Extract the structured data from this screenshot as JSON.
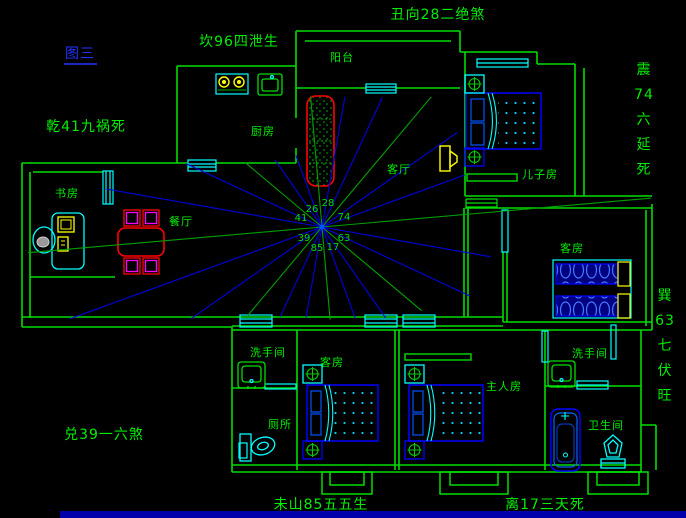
{
  "figure": {
    "label": "图三",
    "color": "#2233ff"
  },
  "annotations": {
    "items": [
      {
        "id": "fig-label",
        "text": "图三",
        "x": 80,
        "y": 58,
        "vertical": false,
        "blue": true,
        "underline": true
      },
      {
        "id": "annot-kan",
        "text": "坎96四泄生",
        "x": 239,
        "y": 46,
        "vertical": false
      },
      {
        "id": "annot-chou",
        "text": "丑向28二绝煞",
        "x": 438,
        "y": 19,
        "vertical": false
      },
      {
        "id": "annot-qian",
        "text": "乾41九祸死",
        "x": 86,
        "y": 131,
        "vertical": false
      },
      {
        "id": "annot-zhen",
        "text": "震74六延死",
        "x": 644,
        "y": 74,
        "vertical": true,
        "lh": 25
      },
      {
        "id": "annot-xun",
        "text": "巽63七伏旺",
        "x": 665,
        "y": 300,
        "vertical": true,
        "lh": 25
      },
      {
        "id": "annot-dui",
        "text": "兑39一六煞",
        "x": 104,
        "y": 439,
        "vertical": false
      },
      {
        "id": "annot-wei",
        "text": "未山85五五生",
        "x": 321,
        "y": 509,
        "vertical": false
      },
      {
        "id": "annot-li",
        "text": "离17三天死",
        "x": 545,
        "y": 509,
        "vertical": false
      }
    ]
  },
  "rooms": {
    "items": [
      {
        "id": "balcony",
        "label": "阳台",
        "x": 342,
        "y": 61
      },
      {
        "id": "kitchen",
        "label": "厨房",
        "x": 263,
        "y": 135
      },
      {
        "id": "study",
        "label": "书房",
        "x": 67,
        "y": 197
      },
      {
        "id": "dining",
        "label": "餐厅",
        "x": 181,
        "y": 225
      },
      {
        "id": "living",
        "label": "客厅",
        "x": 399,
        "y": 173
      },
      {
        "id": "son-room",
        "label": "儿子房",
        "x": 540,
        "y": 178
      },
      {
        "id": "guest-room-east",
        "label": "客房",
        "x": 572,
        "y": 252
      },
      {
        "id": "guest-room-south",
        "label": "客房",
        "x": 332,
        "y": 366
      },
      {
        "id": "master-room",
        "label": "主人房",
        "x": 504,
        "y": 390
      },
      {
        "id": "washroom-west",
        "label": "洗手间",
        "x": 268,
        "y": 356
      },
      {
        "id": "toilet-room",
        "label": "厕所",
        "x": 280,
        "y": 428
      },
      {
        "id": "washroom-east",
        "label": "洗手间",
        "x": 590,
        "y": 357
      },
      {
        "id": "bathroom",
        "label": "卫生间",
        "x": 606,
        "y": 429
      }
    ]
  },
  "compass": {
    "center": {
      "x": 322,
      "y": 227
    },
    "numbers": [
      {
        "value": "26",
        "x": 312,
        "y": 212
      },
      {
        "value": "28",
        "x": 328,
        "y": 206
      },
      {
        "value": "41",
        "x": 301,
        "y": 221
      },
      {
        "value": "74",
        "x": 344,
        "y": 220
      },
      {
        "value": "39",
        "x": 304,
        "y": 241
      },
      {
        "value": "63",
        "x": 344,
        "y": 241
      },
      {
        "value": "85",
        "x": 317,
        "y": 251
      },
      {
        "value": "17",
        "x": 333,
        "y": 250
      }
    ],
    "rays": [
      {
        "angle": 5,
        "len": 330,
        "color": "green"
      },
      {
        "angle": 20,
        "len": 152,
        "color": "blue"
      },
      {
        "angle": 35,
        "len": 165,
        "color": "blue"
      },
      {
        "angle": 50,
        "len": 170,
        "color": "green"
      },
      {
        "angle": 65,
        "len": 143,
        "color": "blue"
      },
      {
        "angle": 80,
        "len": 132,
        "color": "blue"
      },
      {
        "angle": 95,
        "len": 131,
        "color": "green"
      },
      {
        "angle": 110,
        "len": 76,
        "color": "blue"
      },
      {
        "angle": 125,
        "len": 82,
        "color": "blue"
      },
      {
        "angle": 140,
        "len": 100,
        "color": "green"
      },
      {
        "angle": 155,
        "len": 150,
        "color": "blue"
      },
      {
        "angle": 170,
        "len": 219,
        "color": "blue"
      },
      {
        "angle": 185,
        "len": 295,
        "color": "green"
      },
      {
        "angle": 200,
        "len": 268,
        "color": "blue"
      },
      {
        "angle": 215,
        "len": 160,
        "color": "blue"
      },
      {
        "angle": 230,
        "len": 119,
        "color": "green"
      },
      {
        "angle": 245,
        "len": 99,
        "color": "blue"
      },
      {
        "angle": 260,
        "len": 92,
        "color": "blue"
      },
      {
        "angle": 275,
        "len": 93,
        "color": "green"
      },
      {
        "angle": 290,
        "len": 97,
        "color": "blue"
      },
      {
        "angle": 305,
        "len": 111,
        "color": "blue"
      },
      {
        "angle": 320,
        "len": 130,
        "color": "green"
      },
      {
        "angle": 335,
        "len": 163,
        "color": "blue"
      },
      {
        "angle": 350,
        "len": 171,
        "color": "blue"
      }
    ]
  },
  "colors": {
    "background": "#000000",
    "wall": "#00dd00",
    "label": "#00ee00",
    "window": "#00ffff",
    "ray_green": "#00a000",
    "ray_blue": "#0000dd",
    "furniture_blue": "#0000ff",
    "accent_yellow": "#ffff00",
    "accent_red": "#ff0000",
    "accent_magenta": "#ff00ff",
    "figure_blue": "#2233ff",
    "statusbar_blue": "#0000aa"
  }
}
